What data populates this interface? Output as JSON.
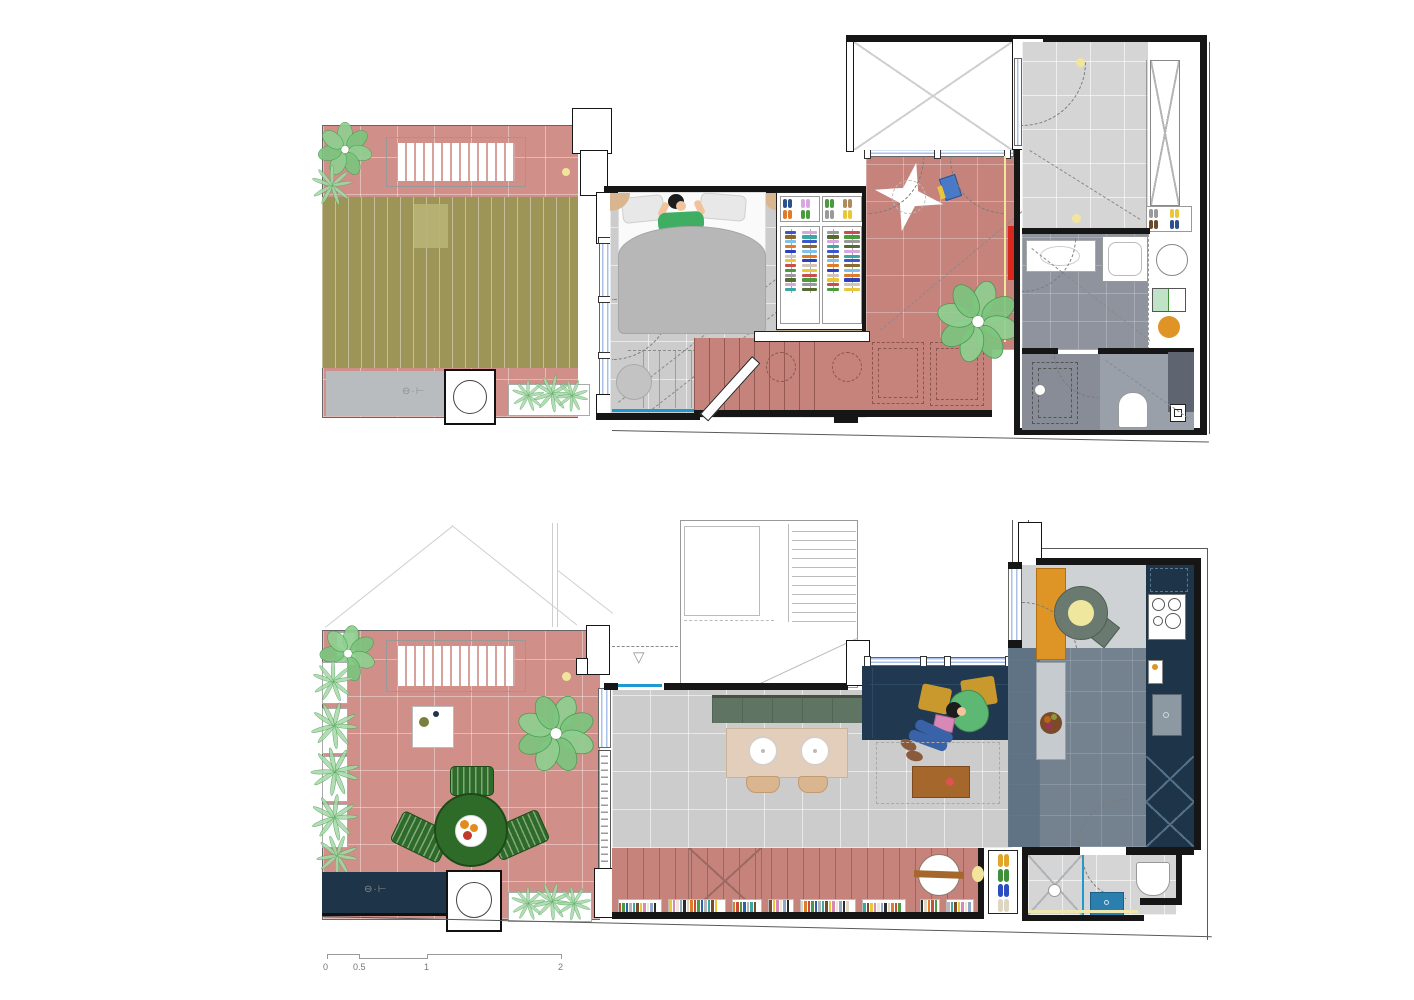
{
  "drawing": {
    "type": "architectural-floor-plans",
    "sheets": [
      "upper-floor-plan",
      "ground-floor-plan"
    ]
  },
  "scale_bar": {
    "ticks": [
      "0",
      "0.5",
      "1",
      "2"
    ]
  },
  "palette": {
    "wall": "#161616",
    "boundary": "#5a5a5a",
    "terracotta": "#d09089",
    "terracotta_deep": "#c5837c",
    "olive_roof": "#9d9557",
    "olive_sky": "#b9b377",
    "floor_gray": "#cccccc",
    "floor_light": "#d5d5d6",
    "bath_gray": "#8e939d",
    "kitchen_floor": "#74828f",
    "kitchen_dark": "#5d7183",
    "kitchen_light": "#cfd2d4",
    "navy": "#1e3448",
    "sofa_navy": "#213950",
    "mustard": "#c9992e",
    "orange": "#df9426",
    "green_table": "#2f6b28",
    "green_dark": "#1e4a18",
    "sage": "#5f7463",
    "sage_chair": "#6b7a70",
    "plant_green": "#7cc47f",
    "plant_dark": "#459a4c",
    "grass_green": "#a6d8a8",
    "wood": "#a5672c",
    "tan": "#d9b690",
    "beige_table": "#e3cebb",
    "glazing": "#a9c0e8",
    "cyan": "#1f9ad0",
    "teal_sink": "#2b7fae",
    "red_accent": "#d8271d",
    "pale_yellow": "#f2e59b",
    "skin": "#f0c39d",
    "jeans": "#3a62a8",
    "pink_book": "#d888b5",
    "shoe_brown": "#8a5a3c",
    "hair": "#1c1c1c",
    "shirt_green": "#3fae62",
    "hood_green": "#5cb873"
  },
  "clothes_colors": [
    "#3b57c8",
    "#4c9a3e",
    "#e07b28",
    "#d9a7e0",
    "#e9c63a",
    "#8a6a2f",
    "#9a9a9a",
    "#2b3fbf",
    "#3aa7a0",
    "#c94f4f",
    "#7fc0e8",
    "#556b2f",
    "#cfc6bb"
  ],
  "book_colors": [
    "#c84b3c",
    "#2b5fb0",
    "#3aa7a0",
    "#e9c63a",
    "#efe6d8",
    "#2b2b2b",
    "#e07b28",
    "#4c9a3e",
    "#b5b5b5",
    "#7a4a2a",
    "#d888b5",
    "#8fa8c8",
    "#ded6c2"
  ],
  "shoe_colors": [
    "#e0a52a",
    "#3f8f3a",
    "#2b4fc0",
    "#ded6c2"
  ],
  "slipper_colors": [
    "#2b4f8f",
    "#d9a7e0",
    "#e07b28",
    "#4c9a3e",
    "#b08a5a",
    "#9a9a9a",
    "#e9c63a",
    "#6a4a2a"
  ],
  "rooms": {
    "upper": [
      "terrace",
      "green-roof",
      "bedroom",
      "wardrobe",
      "kids-room",
      "stairs",
      "void",
      "dressing",
      "bathroom",
      "toilet"
    ],
    "lower": [
      "terrace",
      "entry",
      "communal-stair",
      "living-room",
      "dining-area",
      "kitchen",
      "hall",
      "bathroom"
    ]
  }
}
